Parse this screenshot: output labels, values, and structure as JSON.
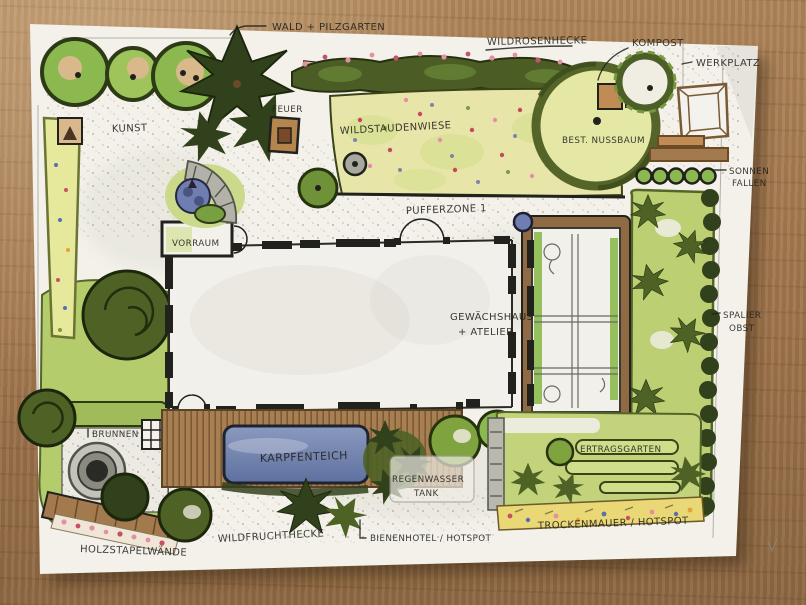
{
  "labels": {
    "wald_pilzgarten": "WALD + PILZGARTEN",
    "wildrosenhecke": "WILDROSENHECKE",
    "kompost": "KOMPOST",
    "werkplatz": "WERKPLATZ",
    "kunst": "KUNST",
    "feuer": "FEUER",
    "wildstaudenwiese": "WILDSTAUDENWIESE",
    "best_nussbaum": "BEST. NUSSBAUM",
    "sonnenfallen_line1": "SONNEN",
    "sonnenfallen_line2": "FALLEN",
    "vorraum": "VORRAUM",
    "pufferzone": "PUFFERZONE 1",
    "gewaechshaus_line1": "GEWÄCHSHAUS",
    "gewaechshaus_line2": "+ ATELIER",
    "spalierobst_line1": "SPALIER",
    "spalierobst_line2": "OBST",
    "brunnen": "BRUNNEN",
    "karpfenteich": "KARPFENTEICH",
    "regenwasser_line1": "REGENWASSER",
    "regenwasser_line2": "TANK",
    "ertragsgarten": "ERTRAGSGARTEN",
    "holzstapelwaende": "HOLZSTAPELWÄNDE",
    "wildfruchthecke": "WILDFRUCHTHECKE",
    "bienenhotel": "BIENENHOTEL / HOTSPOT",
    "trockenmauer": "TROCKENMAUER / HOTSPOT"
  },
  "colors": {
    "wood": "#a3774e",
    "paper": "#f3f1ea",
    "ink": "#21211d",
    "pencil": "#8f8f86",
    "lawn": "#b5cc6c",
    "meadow": "#e8e5a9",
    "canopy": "#8cb94f",
    "darkgreen": "#31411b",
    "olive": "#4e6226",
    "hedge": "#4b5c25",
    "rose": "#e58fa4",
    "pond": "#6d7fa8",
    "timber": "#a27a4e",
    "tan": "#d9b98c",
    "stone": "#aeada3",
    "purple": "#707db0",
    "bedgreen": "#cede8a",
    "dryyellow": "#ead775"
  }
}
